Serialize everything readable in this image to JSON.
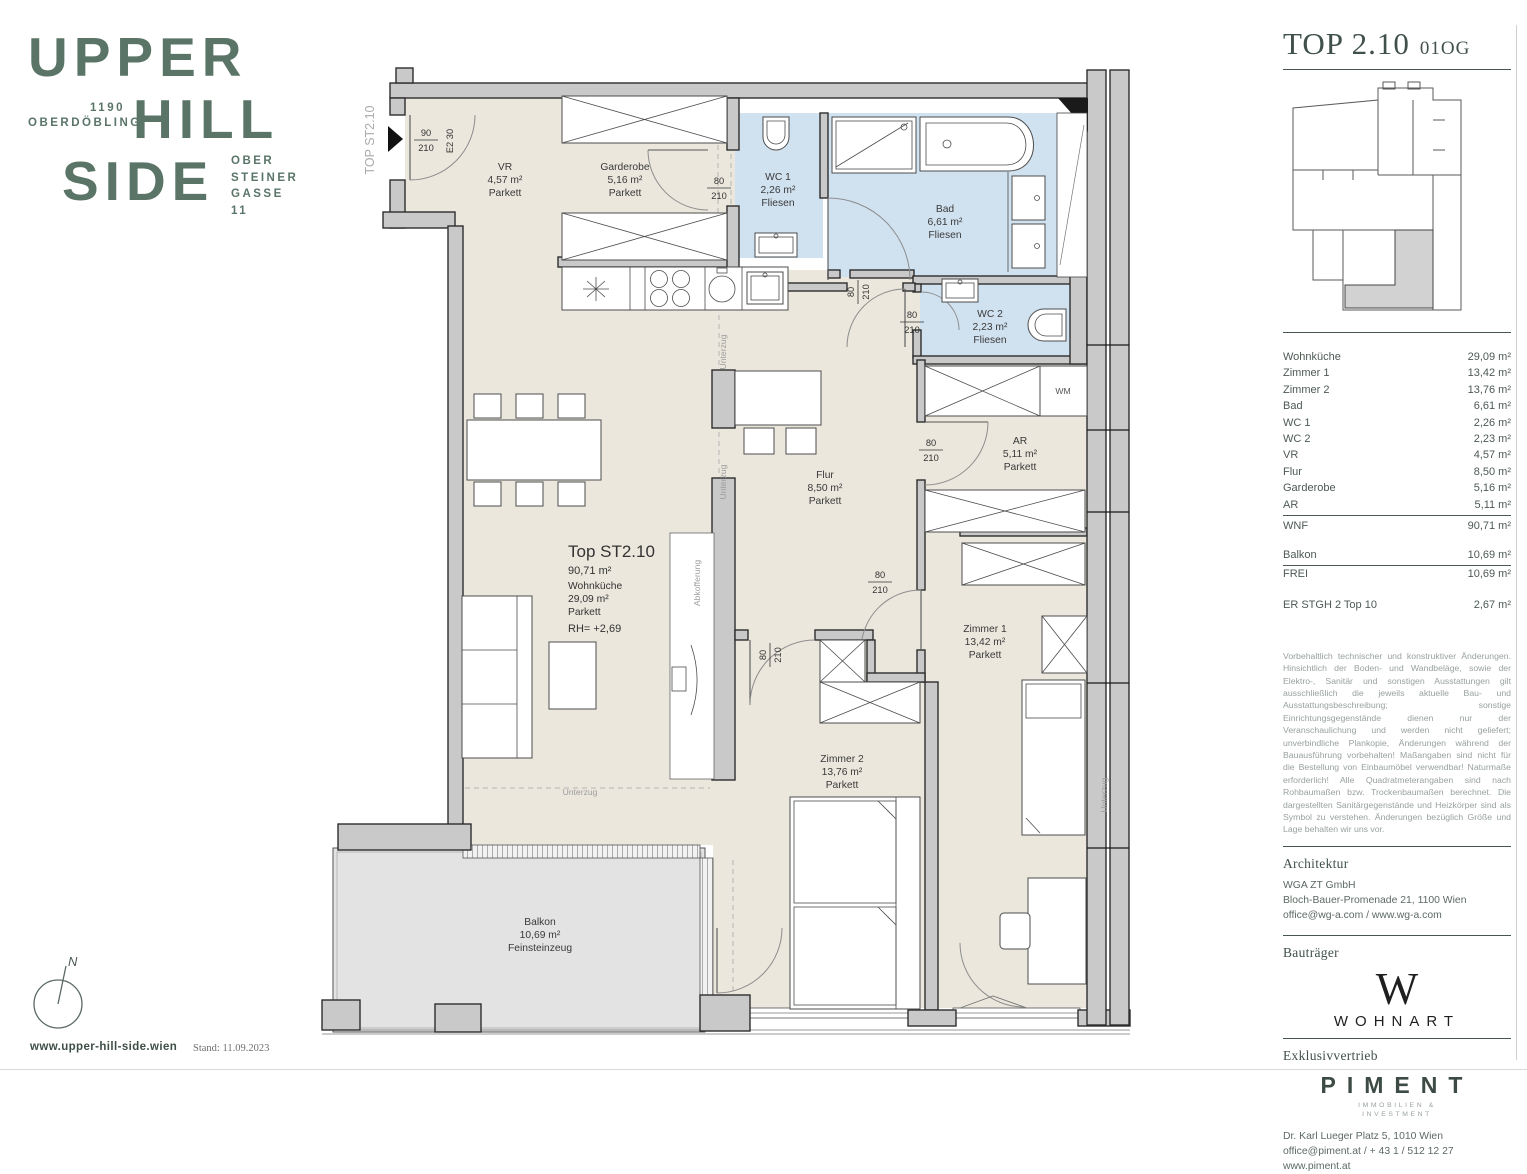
{
  "brand": {
    "line1": "UPPER",
    "line2": "HILL",
    "line3": "SIDE",
    "district_line1": "1190",
    "district_line2": "OBERDÖBLING",
    "addr1": "OBER",
    "addr2": "STEINER",
    "addr3": "GASSE",
    "addr4": "11",
    "website": "www.upper-hill-side.wien",
    "stand": "Stand: 11.09.2023",
    "north": "N"
  },
  "header": {
    "title": "TOP 2.10",
    "floor": "01OG"
  },
  "area_table": {
    "rows": [
      {
        "label": "Wohnküche",
        "value": "29,09 m²"
      },
      {
        "label": "Zimmer 1",
        "value": "13,42 m²"
      },
      {
        "label": "Zimmer 2",
        "value": "13,76 m²"
      },
      {
        "label": "Bad",
        "value": "6,61 m²"
      },
      {
        "label": "WC 1",
        "value": "2,26 m²"
      },
      {
        "label": "WC 2",
        "value": "2,23 m²"
      },
      {
        "label": "VR",
        "value": "4,57 m²"
      },
      {
        "label": "Flur",
        "value": "8,50 m²"
      },
      {
        "label": "Garderobe",
        "value": "5,16 m²"
      },
      {
        "label": "AR",
        "value": "5,11 m²"
      }
    ],
    "wnf": {
      "label": "WNF",
      "value": "90,71 m²"
    },
    "balkon": {
      "label": "Balkon",
      "value": "10,69 m²"
    },
    "frei": {
      "label": "FREI",
      "value": "10,69 m²"
    },
    "er": {
      "label": "ER STGH 2 Top 10",
      "value": "2,67 m²"
    }
  },
  "disclaimer": "Vorbehaltlich technischer und konstruktiver Änderungen. Hinsichtlich der Boden- und Wandbeläge, sowie der Elektro-, Sanitär und sonstigen Ausstattungen gilt ausschließlich die jeweils aktuelle Bau- und Ausstattungsbeschreibung; sonstige Einrichtungsgegenstände dienen nur der Veranschaulichung und werden nicht geliefert; unverbindliche Plankopie, Änderungen während der Bauausführung vorbehalten! Maßangaben sind nicht für die Bestellung von Einbaumöbel verwendbar! Naturmaße erforderlich! Alle Quadratmeterangaben sind nach Rohbaumaßen bzw. Trockenbaumaßen berechnet. Die dargestellten Sanitärgegenstände und Heizkörper sind als Symbol zu verstehen. Änderungen bezüglich Größe und Lage behalten wir uns vor.",
  "architektur": {
    "heading": "Architektur",
    "line1": "WGA ZT GmbH",
    "line2": "Bloch-Bauer-Promenade 21, 1100 Wien",
    "line3": "office@wg-a.com / www.wg-a.com"
  },
  "bautraeger": {
    "heading": "Bauträger",
    "logo_mark": "W",
    "logo_text": "WOHNART"
  },
  "vertrieb": {
    "heading": "Exklusivvertrieb",
    "logo_text": "PIMENT",
    "logo_sub1": "IMMOBILIEN &",
    "logo_sub2": "INVESTMENT",
    "line1": "Dr. Karl Lueger Platz 5, 1010 Wien",
    "line2": "office@piment.at / + 43 1 / 512 12 27",
    "line3": "www.piment.at"
  },
  "plan": {
    "unit_vertical": "TOP ST2.10",
    "main_label": {
      "title": "Top ST2.10",
      "area": "90,71 m²",
      "room": "Wohnküche",
      "room_area": "29,09 m²",
      "floor": "Parkett",
      "rh": "RH= +2,69"
    },
    "rooms": {
      "vr": {
        "name": "VR",
        "area": "4,57 m²",
        "floor": "Parkett"
      },
      "garderobe": {
        "name": "Garderobe",
        "area": "5,16 m²",
        "floor": "Parkett"
      },
      "wc1": {
        "name": "WC 1",
        "area": "2,26 m²",
        "floor": "Fliesen"
      },
      "bad": {
        "name": "Bad",
        "area": "6,61 m²",
        "floor": "Fliesen"
      },
      "wc2": {
        "name": "WC 2",
        "area": "2,23 m²",
        "floor": "Fliesen"
      },
      "ar": {
        "name": "AR",
        "area": "5,11 m²",
        "floor": "Parkett"
      },
      "flur": {
        "name": "Flur",
        "area": "8,50 m²",
        "floor": "Parkett"
      },
      "zimmer1": {
        "name": "Zimmer 1",
        "area": "13,42 m²",
        "floor": "Parkett"
      },
      "zimmer2": {
        "name": "Zimmer 2",
        "area": "13,76 m²",
        "floor": "Parkett"
      },
      "balkon": {
        "name": "Balkon",
        "area": "10,69 m²",
        "floor": "Feinsteinzeug"
      }
    },
    "dims": {
      "d90": "90",
      "d80": "80",
      "d210": "210",
      "entry_code": "E2 30"
    },
    "annot": {
      "unterzug": "Unterzug",
      "abkofferung": "Abkofferung",
      "wm": "WM"
    }
  },
  "colors": {
    "brand_green": "#5a7568",
    "heading_green": "#40514a",
    "floor_cream": "#ebe7dd",
    "wet_blue": "#d0e1f0",
    "balcony_gray": "#e3e3e3",
    "wall_gray": "#c9c9c9"
  }
}
